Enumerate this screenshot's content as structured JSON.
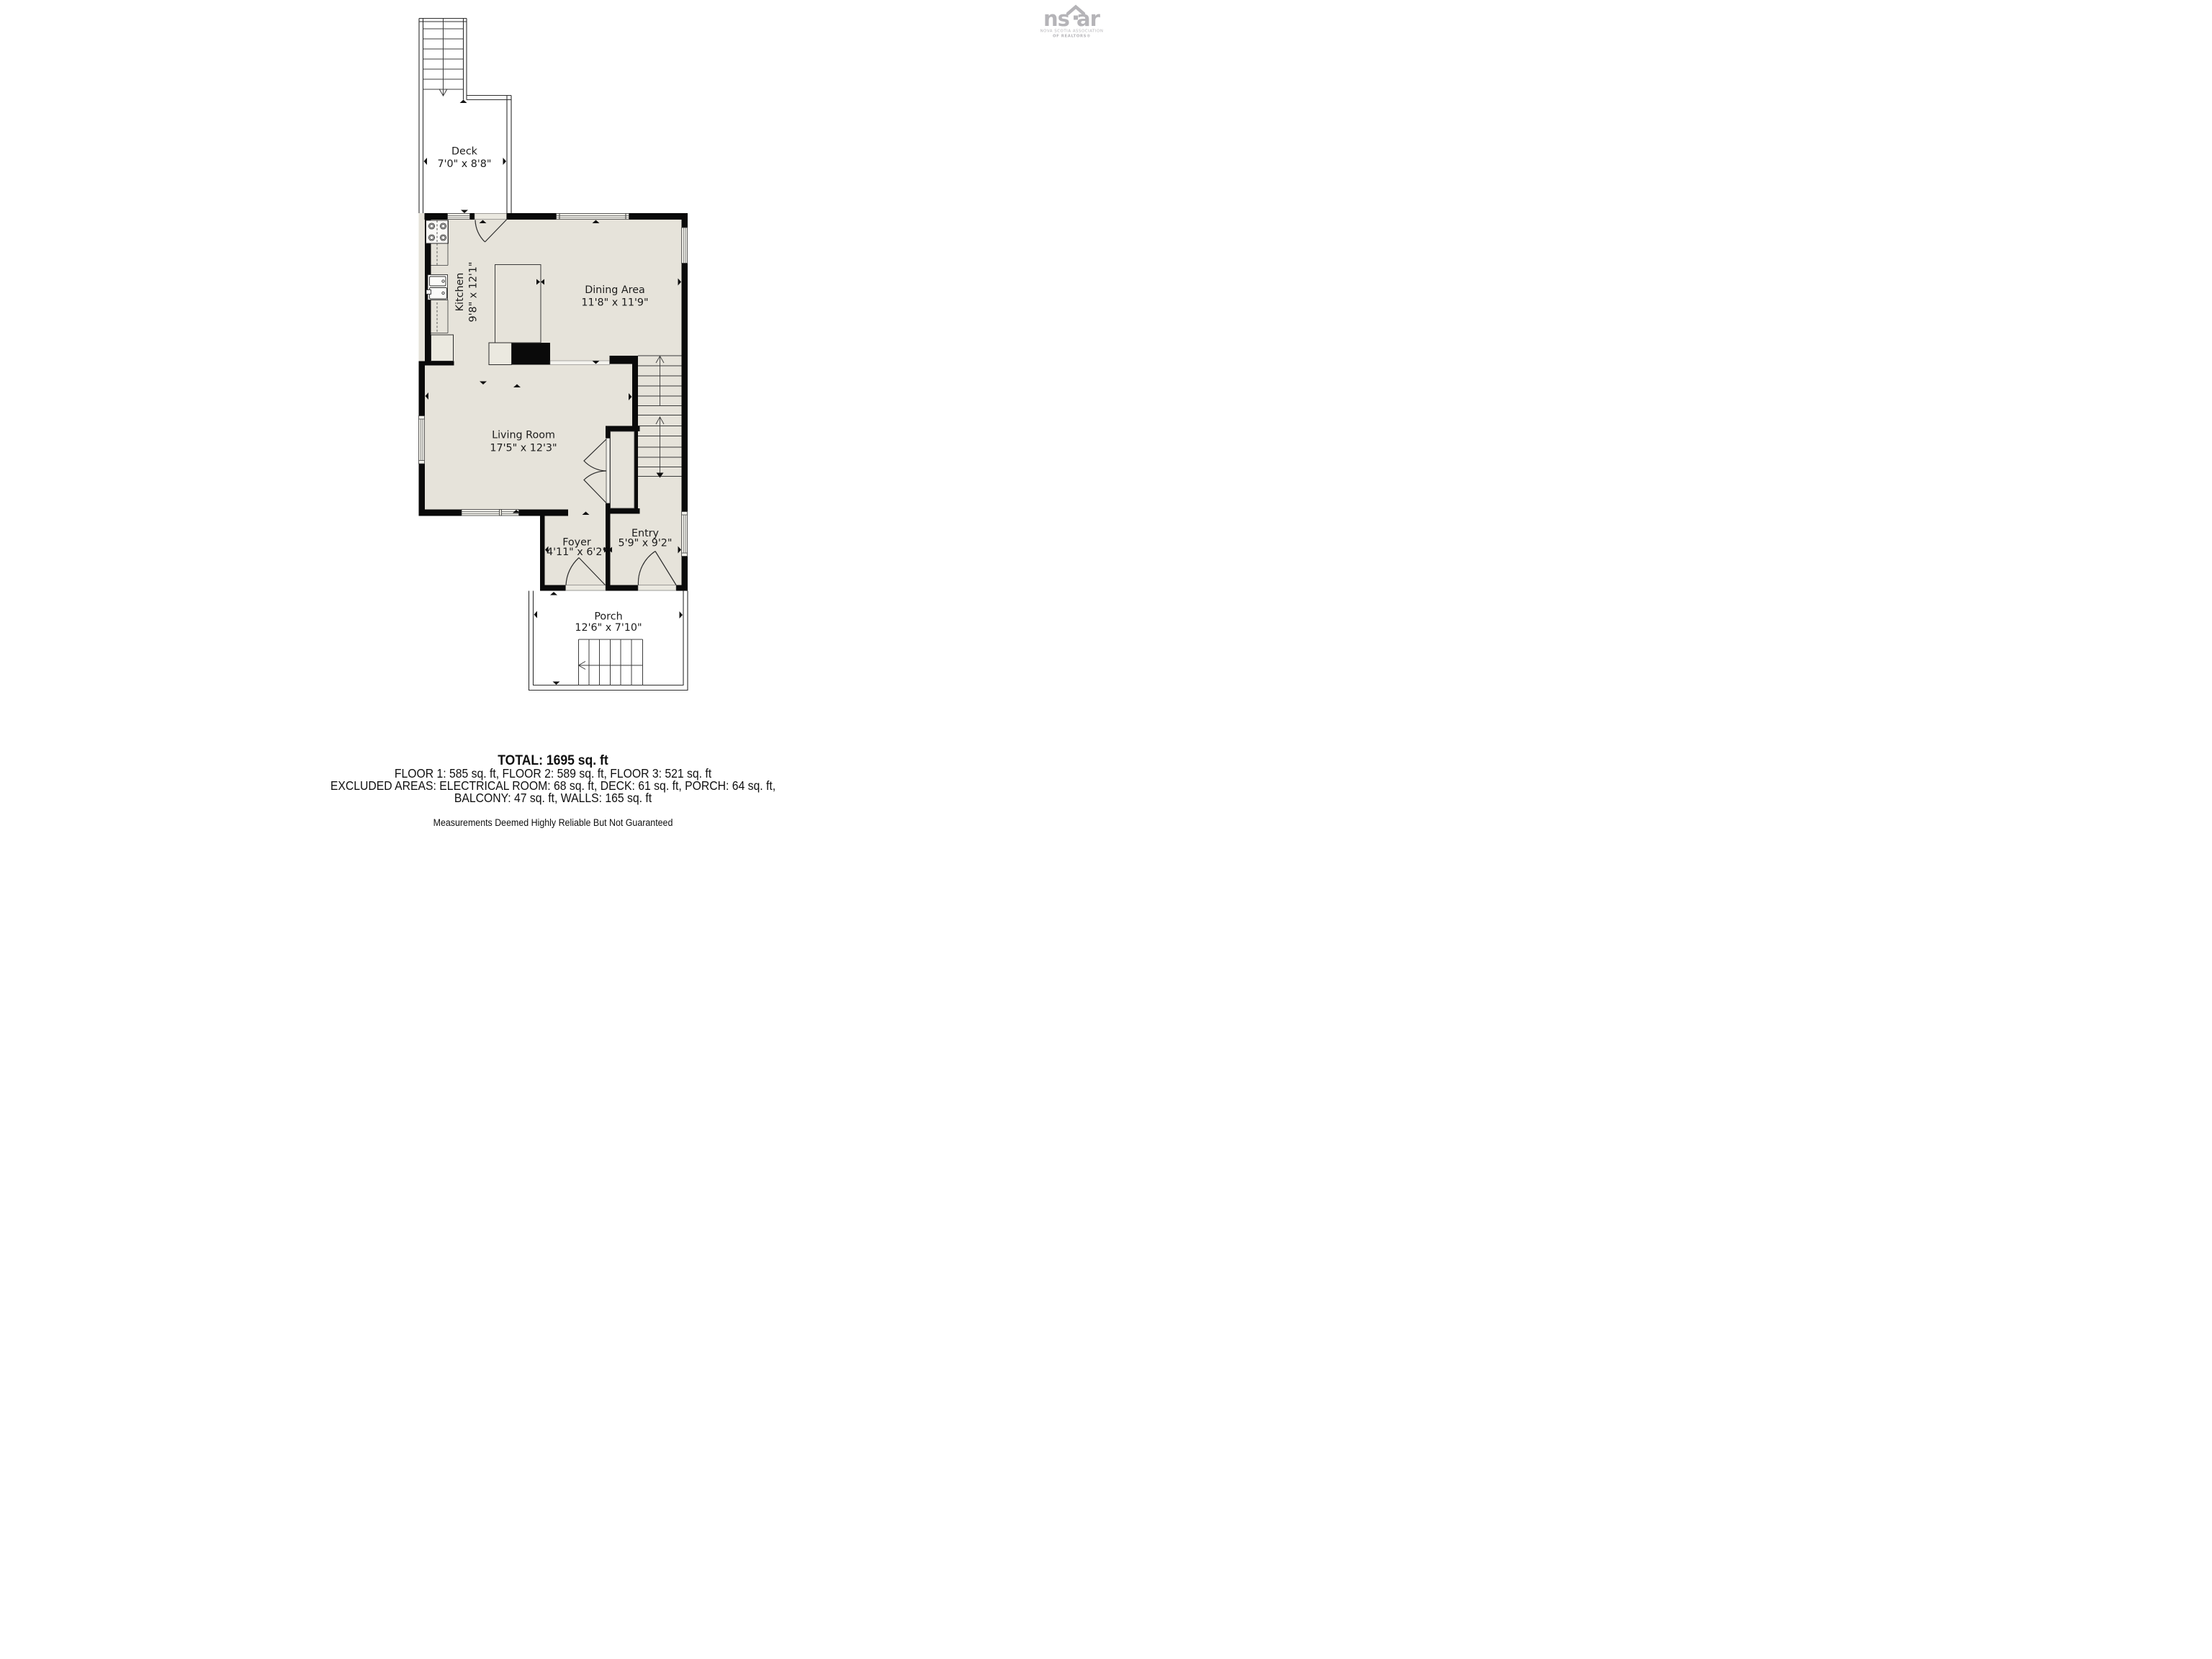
{
  "logo": {
    "brand_left": "ns",
    "brand_right": "ar",
    "line1": "NOVA SCOTIA ASSOCIATION",
    "line2": "OF REALTORS®"
  },
  "rooms": [
    {
      "id": "deck",
      "name": "Deck",
      "dims": "7'0\" x 8'8\""
    },
    {
      "id": "kitchen",
      "name": "Kitchen",
      "dims": "9'8\" x 12'1\""
    },
    {
      "id": "dining",
      "name": "Dining Area",
      "dims": "11'8\" x 11'9\""
    },
    {
      "id": "living",
      "name": "Living Room",
      "dims": "17'5\" x 12'3\""
    },
    {
      "id": "foyer",
      "name": "Foyer",
      "dims": "4'11\" x 6'2\""
    },
    {
      "id": "entry",
      "name": "Entry",
      "dims": "5'9\" x 9'2\""
    },
    {
      "id": "porch",
      "name": "Porch",
      "dims": "12'6\" x 7'10\""
    }
  ],
  "summary": {
    "total": "TOTAL: 1695 sq. ft",
    "floors": "FLOOR 1: 585 sq. ft, FLOOR 2: 589 sq. ft, FLOOR 3: 521 sq. ft",
    "excluded": "EXCLUDED AREAS: ELECTRICAL ROOM: 68 sq. ft, DECK: 61 sq. ft, PORCH: 64 sq. ft,",
    "excluded2": "BALCONY: 47 sq. ft, WALLS: 165 sq. ft",
    "disclaimer": "Measurements Deemed Highly Reliable But Not Guaranteed"
  },
  "colors": {
    "wall": "#0a0a0a",
    "floor": "#e6e3da",
    "window": "#f2f1eb",
    "logo_gray": "#b5b4b8"
  }
}
